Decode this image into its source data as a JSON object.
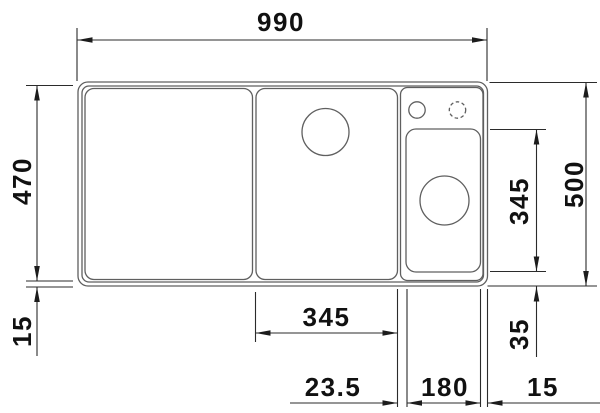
{
  "diagram": {
    "type": "technical-dimension-drawing",
    "subject": "kitchen sink top view with chained dimensions",
    "units": "mm",
    "colors": {
      "background": "#ffffff",
      "outline": "#5f5f5f",
      "dimension_line": "#2b2b2b",
      "text": "#111111"
    },
    "labels": {
      "overall_width": "990",
      "inner_depth": "470",
      "front_rim": "15",
      "overall_depth": "500",
      "right_bowl_length": "345",
      "rear_gap": "35",
      "main_bowl_width": "345",
      "divider_width": "23.5",
      "right_bowl_width": "180",
      "right_rim": "15"
    }
  }
}
